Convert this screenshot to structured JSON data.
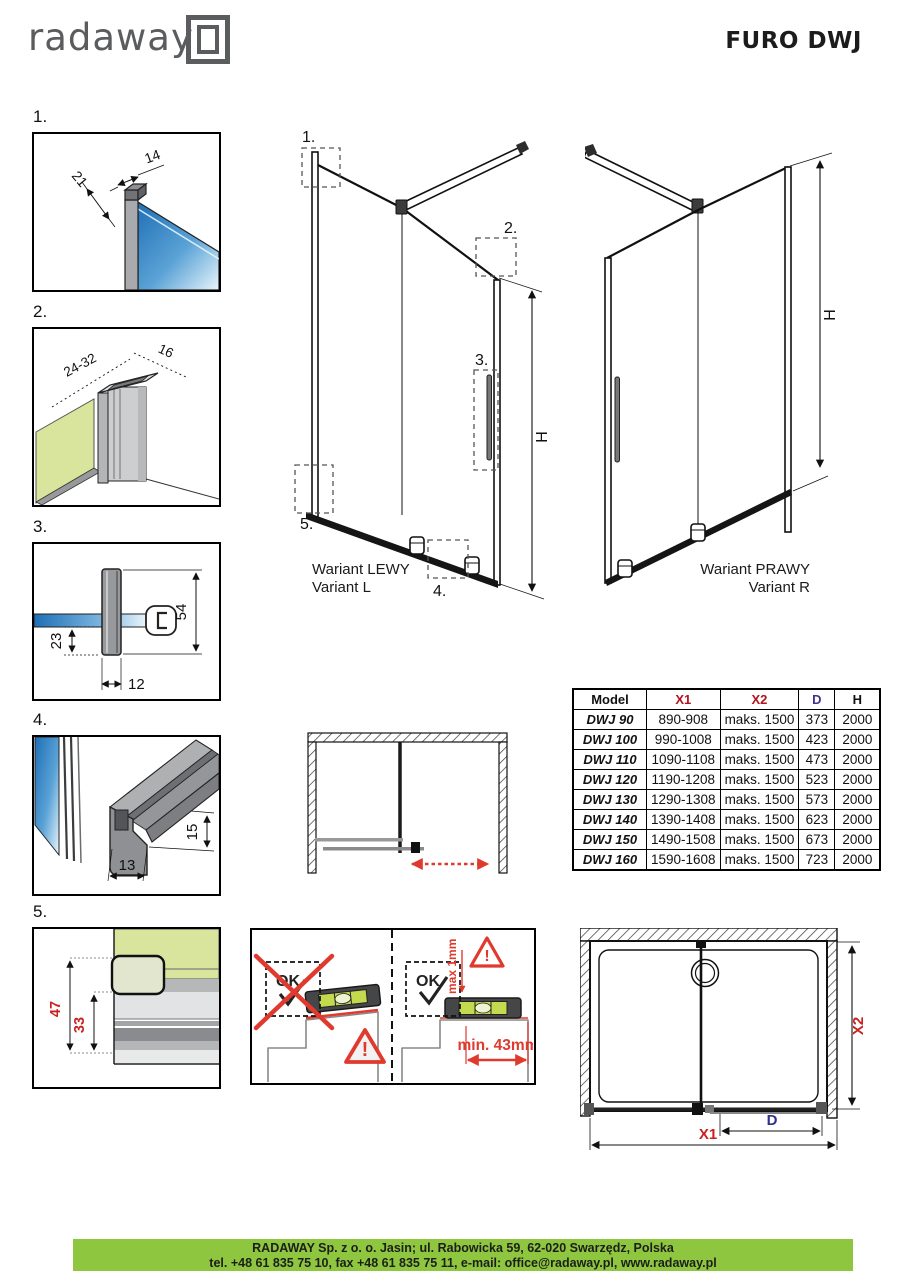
{
  "header": {
    "logo_text": "radaway",
    "title": "FURO DWJ"
  },
  "callouts": [
    "1.",
    "2.",
    "3.",
    "4.",
    "5."
  ],
  "diagrams": {
    "d1": {
      "dim_top_width": "14",
      "dim_depth": "21"
    },
    "d2": {
      "dim_range": "24-32",
      "dim_width": "16"
    },
    "d3": {
      "dim_offset": "23",
      "dim_height": "54",
      "dim_width": "12"
    },
    "d4": {
      "dim_width": "13",
      "dim_height": "15"
    },
    "d5": {
      "dim_total": "47",
      "dim_inner": "33"
    }
  },
  "variants": {
    "left": {
      "name_pl": "Wariant LEWY",
      "name_en": "Variant L",
      "dim_h": "H"
    },
    "right": {
      "name_pl": "Wariant PRAWY",
      "name_en": "Variant R",
      "dim_h": "H"
    }
  },
  "table": {
    "headers": [
      "Model",
      "X1",
      "X2",
      "D",
      "H"
    ],
    "rows": [
      [
        "DWJ 90",
        "890-908",
        "maks. 1500",
        "373",
        "2000"
      ],
      [
        "DWJ 100",
        "990-1008",
        "maks. 1500",
        "423",
        "2000"
      ],
      [
        "DWJ 110",
        "1090-1108",
        "maks. 1500",
        "473",
        "2000"
      ],
      [
        "DWJ 120",
        "1190-1208",
        "maks. 1500",
        "523",
        "2000"
      ],
      [
        "DWJ 130",
        "1290-1308",
        "maks. 1500",
        "573",
        "2000"
      ],
      [
        "DWJ 140",
        "1390-1408",
        "maks. 1500",
        "623",
        "2000"
      ],
      [
        "DWJ 150",
        "1490-1508",
        "maks. 1500",
        "673",
        "2000"
      ],
      [
        "DWJ 160",
        "1590-1608",
        "maks. 1500",
        "723",
        "2000"
      ]
    ]
  },
  "leveling": {
    "ok_bad": "OK",
    "ok_good": "OK",
    "warning_mark": "!",
    "max_gap": "max 1mm",
    "min_distance": "min. 43mm"
  },
  "plan": {
    "dim_x1": "X1",
    "dim_x2": "X2",
    "dim_d": "D"
  },
  "footer": {
    "address": "RADAWAY Sp. z o. o. Jasin; ul. Rabowicka 59, 62-020 Swarzędz, Polska",
    "contact": "tel. +48 61 835 75 10, fax +48 61 835 75 11, e-mail: office@radaway.pl, www.radaway.pl"
  },
  "colors": {
    "glass_blue": "#2470b3",
    "wall_green": "#d9e49c",
    "footer_green": "#8ec73f",
    "accent_red": "#e03a2f",
    "table_red": "#b5121b",
    "table_purple": "#3f3391"
  }
}
